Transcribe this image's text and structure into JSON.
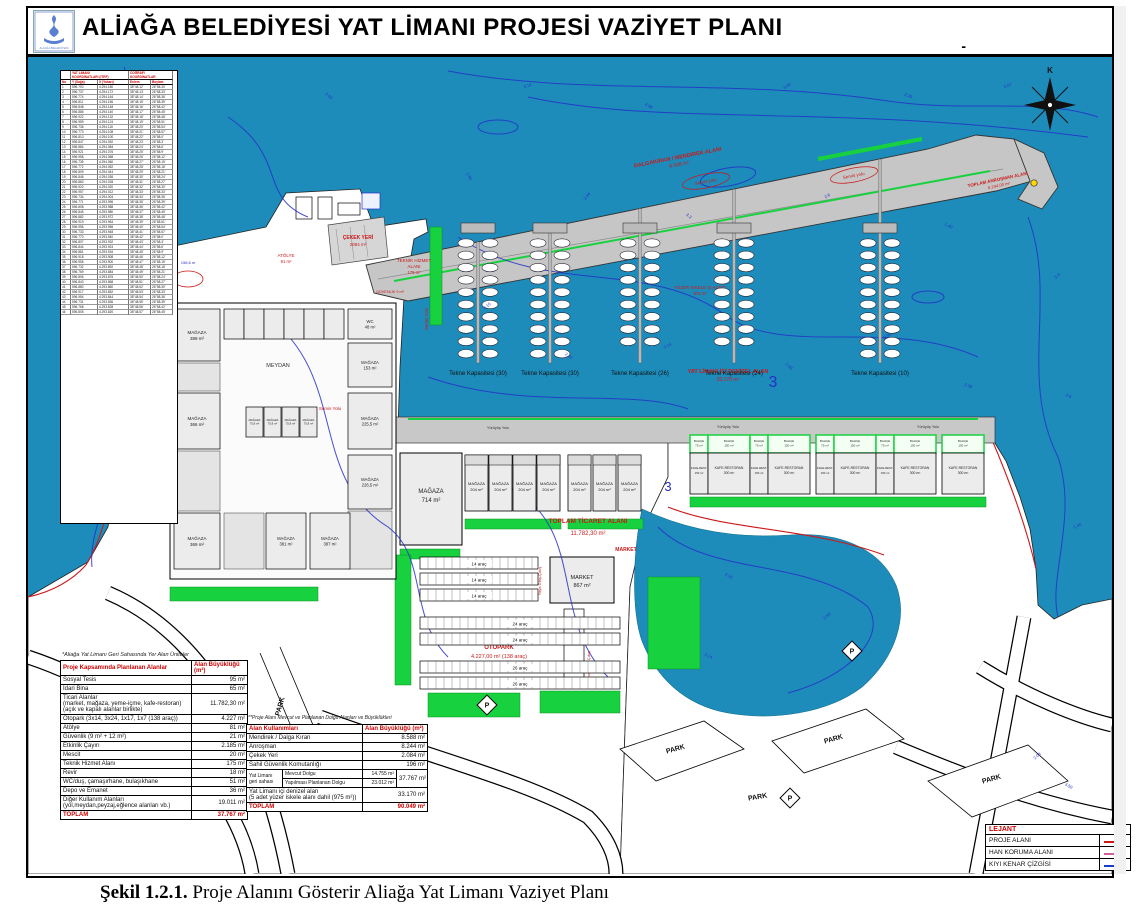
{
  "window": {
    "title": "ALİAĞA BELEDİYESİ YAT LİMANI PROJESİ VAZİYET PLANI",
    "corner_mark": "-",
    "logo_caption": "ALİAĞA BELEDİYESİ"
  },
  "caption": {
    "label": "Şekil 1.2.1.",
    "text": " Proje Alanını Gösterir Aliağa Yat Limanı Vaziyet Planı"
  },
  "colors": {
    "water": "#1d8cba",
    "contour": "#2431c8",
    "red": "#cc1818",
    "green": "#17d23e",
    "pier_gray": "#c6c6c6",
    "road_gray": "#b5b5b5"
  },
  "compass": {
    "north_label": "K"
  },
  "coord_table": {
    "group_headers": [
      "YAT LİMANI\nKOORDİNATLARI (ITRF)",
      "COĞRAFİ\nKOORDİNATLAR"
    ],
    "columns": [
      "No",
      "Y (Sağa)",
      "X (Yukarı)",
      "Enlem",
      "Boylam"
    ],
    "row_count": 46
  },
  "plan": {
    "sea_labels": [
      "2.50",
      "3.14",
      "2.08",
      "3.50",
      "2.26",
      "3.07",
      "1.90",
      "2.84",
      "3.3",
      "2.6",
      "1.40",
      "3.10"
    ],
    "big_depth": "3",
    "annotations": {
      "dalgakiran_line1": "DALGAKIRAN / MENDİREK ALANI",
      "dalgakiran_line2": "8.588 m²",
      "servis_yolu": "Servis yolu",
      "servis_yolu2": "Servis Yolu",
      "anrosman_line1": "TOPLAM ANROŞMAN ALANI",
      "anrosman_line2": "8.244,00 m²",
      "cekek_line1": "ÇEKEK YERİ",
      "cekek_line2": "2084 m²",
      "teknik_line1": "TEKNİK HİZMET",
      "teknik_line2": "ALANI",
      "teknik_line3": "175 m²",
      "atolye_line1": "ATÖLYE",
      "atolye_line2": "81 m²",
      "guvenlik": "GÜVENLİK 9 m²",
      "iskele_line1": "YÜZER İSKELE (5 ADET)",
      "iskele_line2": "975 m²",
      "deniz_line1": "YAT LİMANI İÇİ DENİZEL ALAN",
      "deniz_line2": "33.170 m²",
      "ticaret_line1": "TOPLAM TİCARET ALANI",
      "ticaret_line2": "11.782,30 m²",
      "otopark_line1": "OTOPARK",
      "otopark_line2": "4.227,00 m² (138 araç)",
      "market_red": "MARKET",
      "meydan": "MEYDAN",
      "yuruyus_yolu": "Yürüyüş Yolu",
      "yaya_giris": "Yaya Giriş-Çıkış",
      "arac_giris": "Araç Giriş-Çıkış",
      "depth_note": "156,6 m"
    },
    "piers": [
      "Tekne Kapasitesi (30)",
      "Tekne Kapasitesi (30)",
      "Tekne Kapasitesi (26)",
      "Tekne Kapasitesi (24)",
      "Tekne Kapasitesi (10)"
    ],
    "buildings": {
      "magaza_left": [
        "MAĞAZA\n389 m²",
        "MAĞAZA\n366 m²",
        "MAĞAZA\n369 m²"
      ],
      "magaza_right": [
        "WC\n48 m²",
        "MAĞAZA\n153 m²",
        "MAĞAZA\n225,5 m²",
        "MAĞAZA\n226,5 m²"
      ],
      "magaza_center": [
        "MAĞAZA\n75,8 m²",
        "MAĞAZA\n75,8 m²",
        "MAĞAZA\n75,8 m²",
        "MAĞAZA\n75,8 m²"
      ],
      "magaza_bottom": [
        "MAĞAZA\n381 m²",
        "MAĞAZA\n387 m²"
      ],
      "magaza_big": "MAĞAZA\n714 m²",
      "magaza_unit": "MAĞAZA\n204 m²",
      "market": "MARKET\n867 m²",
      "kafe_narrow": "KAFE-REST.\n150 m²",
      "kafe_wide": "KAFE-RESTORAN\n300 m²",
      "bahce_narrow": "BAHÇE\n75 m²",
      "bahce_wide": "BAHÇE\n150 m²"
    },
    "parking_rows": [
      "14 araç",
      "14 araç",
      "14 araç",
      "24 araç",
      "24 araç",
      "26 araç",
      "26 araç"
    ],
    "park_label": "PARK",
    "p_symbol": "P"
  },
  "table1": {
    "note": "*Aliağa Yat Limanı Geri Sahasında Yer Alan Üniteler",
    "headers": [
      "Proje Kapsamında Planlanan Alanlar",
      "Alan Büyüklüğü (m²)"
    ],
    "rows": [
      [
        "Sosyal Tesis",
        "95 m²"
      ],
      [
        "İdari Bina",
        "65 m²"
      ],
      [
        "Ticari Alanlar\n(market, mağaza, yeme-içme, kafe-restoran)\n(açık ve kapalı alanlar birlikte)",
        "11.782,30 m²"
      ],
      [
        "Otopark (3x14, 3x24, 1x17, 1x7 (138 araç))",
        "4.227 m²"
      ],
      [
        "Atölye",
        "81 m²"
      ],
      [
        "Güvenlik (9 m² + 12 m²)",
        "21 m²"
      ],
      [
        "Etkinlik Çayırı",
        "2.185 m²"
      ],
      [
        "Mescit",
        "20 m²"
      ],
      [
        "Teknik Hizmet Alanı",
        "175 m²"
      ],
      [
        "Revir",
        "18 m²"
      ],
      [
        "WC/duş, çamaşırhane, bulaşıkhane",
        "51 m²"
      ],
      [
        "Depo ve Emanet",
        "36 m²"
      ],
      [
        "Diğer Kullanım Alanları\n(yol,meydan,peyzaj,eğlence alanları vb.)",
        "19.011 m²"
      ]
    ],
    "total": [
      "TOPLAM",
      "37.767 m²"
    ]
  },
  "table2": {
    "note": "**Proje Alanı Mevcut ve Planlanan Dolgu Alanları ve Büyüklükleri",
    "headers": [
      "Alan Kullanımları",
      "Alan Büyüklüğü (m²)"
    ],
    "rows": [
      [
        "Mendirek / Dalga Kıran",
        "8.588 m²"
      ],
      [
        "Anroşman",
        "8.244 m²"
      ],
      [
        "Çekek Yeri",
        "2.084 m²"
      ],
      [
        "Sahil Güvenlik Komutanlığı",
        "196 m²"
      ]
    ],
    "geri": {
      "label": "Yat Limanı\ngeri sahası",
      "sub": [
        [
          "Mevcut Dolgu",
          "14.755 m²"
        ],
        [
          "Yapılması Planlanan Dolgu",
          "23.012 m²"
        ]
      ],
      "total": "37.767 m²"
    },
    "denizel": [
      "Yat Limanı içi denizel alan\n(5 adet yüzer iskele alanı dahil (975 m²))",
      "33.170 m²"
    ],
    "total": [
      "TOPLAM",
      "90.049 m²"
    ]
  },
  "legend": {
    "title": "LEJANT",
    "items": [
      {
        "label": "PROJE ALANI",
        "swatch": "#cc1818"
      },
      {
        "label": "HAN KORUMA ALANI",
        "swatch": "#d060a0"
      },
      {
        "label": "KIYI KENAR ÇİZGİSİ",
        "swatch": "#1a3bd0"
      }
    ]
  }
}
